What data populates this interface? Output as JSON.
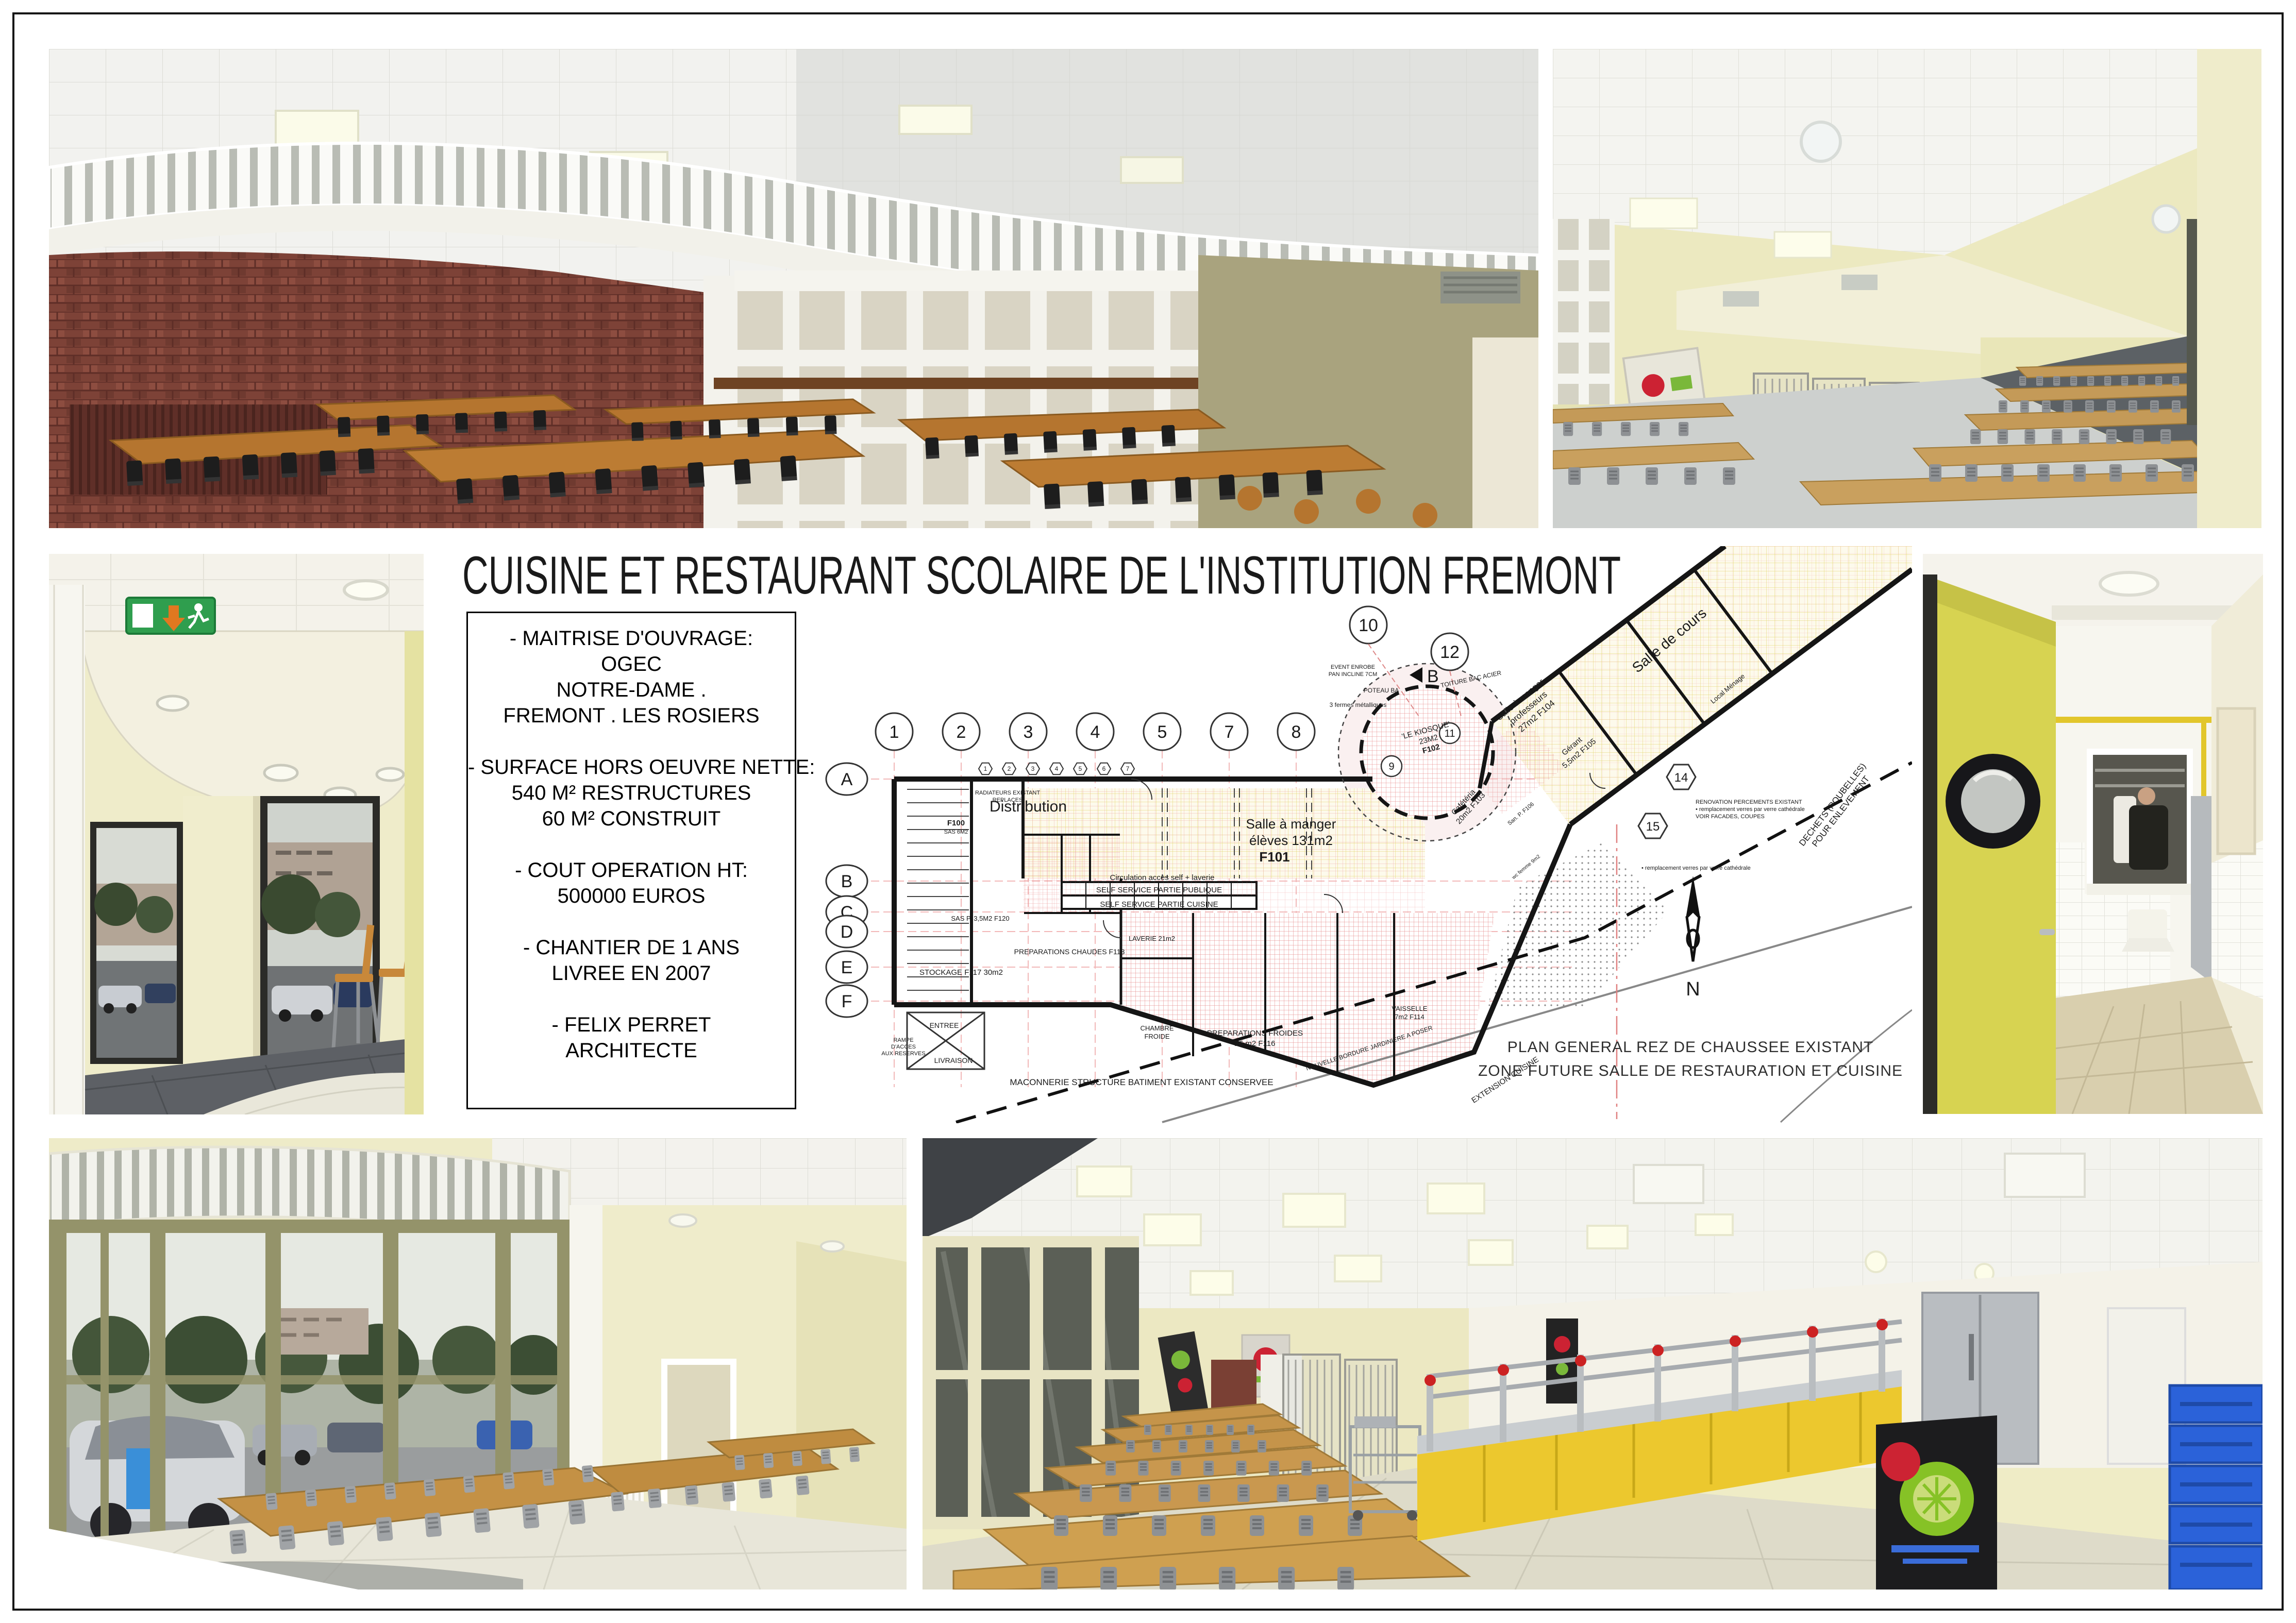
{
  "board": {
    "title": "CUISINE ET RESTAURANT SCOLAIRE DE L'INSTITUTION FREMONT"
  },
  "info": {
    "paragraphs": [
      {
        "lines": [
          "- MAITRISE D'OUVRAGE:",
          "OGEC",
          "NOTRE-DAME .",
          "FREMONT . LES ROSIERS"
        ]
      },
      {
        "lines": [
          "- SURFACE HORS OEUVRE NETTE:",
          "540 M² RESTRUCTURES",
          "60 M² CONSTRUIT"
        ]
      },
      {
        "lines": [
          "- COUT OPERATION HT:",
          "500000 EUROS"
        ]
      },
      {
        "lines": [
          "- CHANTIER DE 1 ANS",
          "LIVREE EN 2007"
        ]
      },
      {
        "lines": [
          "- FELIX PERRET",
          "ARCHITECTE"
        ]
      }
    ]
  },
  "plan": {
    "caption_1": "PLAN GENERAL REZ DE CHAUSSEE EXISTANT",
    "caption_2": "ZONE FUTURE SALLE DE RESTAURATION ET CUISINE",
    "north": "N",
    "section_marker": "B",
    "grid_cols": [
      "1",
      "2",
      "3",
      "4",
      "5",
      "7",
      "8"
    ],
    "grid_rows": [
      "A",
      "B",
      "C",
      "D",
      "E",
      "F"
    ],
    "upper_bubbles": [
      "10",
      "12"
    ],
    "hex_markers": [
      "14",
      "15"
    ],
    "detail_markers": [
      "9",
      "11"
    ],
    "window_markers": [
      "1",
      "2",
      "3",
      "4",
      "5",
      "6",
      "7"
    ],
    "labels": {
      "distribution": "Distribution",
      "salle_eleves_1": "Salle à manger",
      "salle_eleves_2": "élèves 131m2",
      "salle_eleves_3": "F101",
      "kiosque_1": "'LE KIOSQUE'",
      "kiosque_2": "23M2",
      "kiosque_3": "F102",
      "cafeteria_1": "Cafétéria",
      "cafeteria_2": "20m2 F103",
      "profs_1": "Salle à manger",
      "profs_2": "professeurs",
      "profs_3": "27m2 F104",
      "gerant_1": "Gérant",
      "gerant_2": "5,5m2 F105",
      "san_p": "San. P. F106",
      "wc_femme": "wc femme 9m2",
      "salle_cours": "Salle de cours",
      "local_menage": "Local Ménage",
      "self_1": "SELF SERVICE PARTIE PUBLIQUE",
      "self_2": "SELF SERVICE PARTIE CUISINE",
      "circulation": "Circulation accès self + laverie",
      "laverie": "LAVERIE 21m2",
      "f100_1": "F100",
      "f100_2": "SAS 6M2",
      "radiateurs_1": "RADIATEURS EXISTANT",
      "radiateurs_2": "REPLACES",
      "sas_p": "SAS P. 3,5M2 F120",
      "stockage": "STOCKAGE F117 30m2",
      "prep_chaudes": "PREPARATIONS CHAUDES F113",
      "prep_froides_1": "PREPARATIONS FROIDES",
      "prep_froides_2": "26 m2 F116",
      "chambre_froide_1": "CHAMBRE",
      "chambre_froide_2": "FROIDE",
      "vaisselle_1": "VAISSELLE",
      "vaisselle_2": "7m2 F114",
      "entree": "ENTREE",
      "livraison": "LIVRAISON",
      "rampe_1": "RAMPE",
      "rampe_2": "D'ACCES",
      "rampe_3": "AUX RESERVES",
      "poteau": "POTEAU BA",
      "fermes": "3 fermes métalliques",
      "toiture": "TOITURE BAC ACIER",
      "event_1": "EVENT ENROBE",
      "event_2": "PAN INCLINE 7CM",
      "renovation_1": "RENOVATION PERCEMENTS EXISTANT",
      "renovation_2": "• remplacement verres par verre cathédrale",
      "renovation_3": "VOIR FACADES, COUPES",
      "remplacement": "• remplacement verres par verre cathédrale",
      "dechets_1": "DECHETS (POUBELLES)",
      "dechets_2": "POUR ENLEVEMENT",
      "maconnerie": "MACONNERIE STRUCTURE BATIMENT EXISTANT CONSERVEE",
      "extension": "EXTENSION CUISINE",
      "bordure": "NOUVELLE BORDURE JARDINIERE A POSER"
    }
  },
  "photos": {
    "top_left": "Salle de restaurant existante : mur de briques, claustra blanc, tables bois",
    "top_right": "Salle de restaurant : chariots inox, tables et chaises, murs jaune pâle",
    "mid_left": "Hall d'entrée : issue de secours, piliers, vitrage sur rue",
    "mid_right": "Couloir cuisine : porte jaune à hublot, carrelage blanc",
    "bottom_left": "Façade vitrée de l'entrée : menuiserie olive, parking et arbres",
    "bottom_right": "Salle de restauration : banque de self jaune et inox, casiers bleus"
  },
  "colors": {
    "brick": "#7d4237",
    "wall_yellow": "#e9e6b8",
    "door_yellow": "#d7d351",
    "counter_yellow": "#ecc82e",
    "plan_hatch_red": "#e06868",
    "plan_zone_yellow": "#fdfaec"
  }
}
